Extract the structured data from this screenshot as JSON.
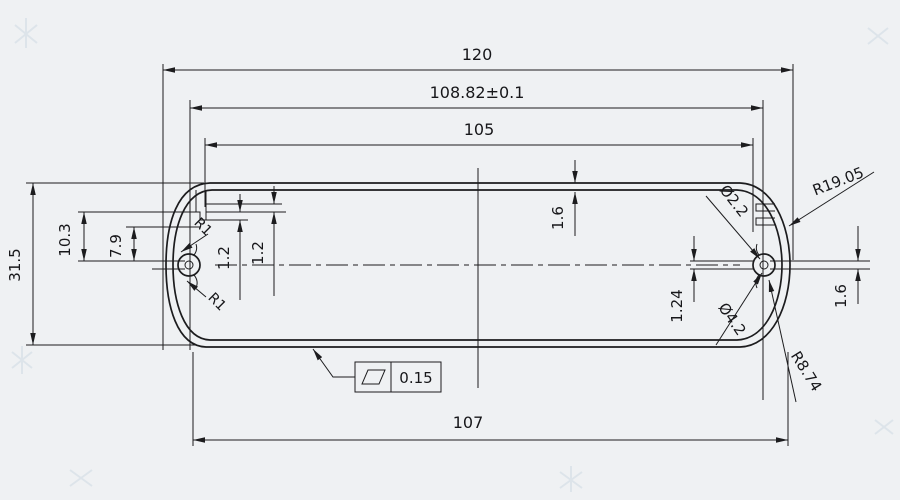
{
  "drawing": {
    "type": "extrusion-profile-cross-section",
    "colors": {
      "background": "#eff1f3",
      "ink": "#1c1c1e"
    },
    "dims": {
      "overall_width": "120",
      "hole_spacing": "108.82±0.1",
      "inner_width": "105",
      "overall_height": "31.5",
      "tab_depth": "10.3",
      "rib_depth": "7.9",
      "rib_step_a": "1.2",
      "rib_step_b": "1.2",
      "wall_thickness": "1.6",
      "slot_height": "1.6",
      "web_offset": "1.24",
      "bottom_width": "107",
      "fillet_top": "R1",
      "fillet_bottom": "R1",
      "screw_hole_dia": "Ø2.2",
      "end_radius": "R19.05",
      "boss_dia": "Ø4.2",
      "corner_radius": "R8.74"
    },
    "gdt": {
      "symbol_icon": "flatness-parallelogram",
      "flatness_value": "0.15"
    }
  }
}
